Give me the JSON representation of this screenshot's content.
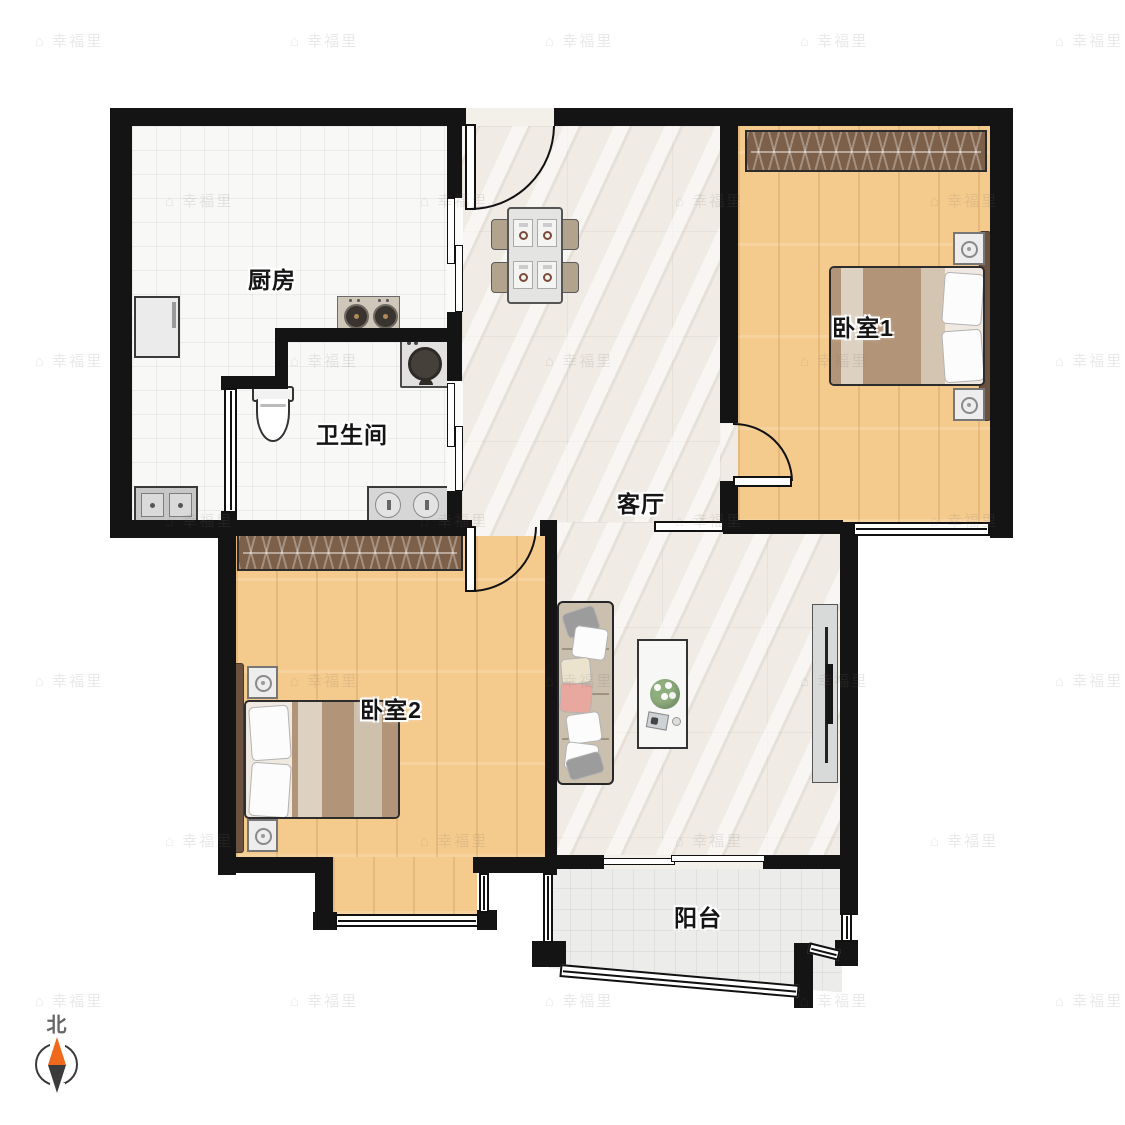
{
  "rooms": {
    "kitchen": {
      "label": "厨房",
      "furniture": [
        "refrigerator",
        "gas-stove",
        "kitchen-sink"
      ]
    },
    "bathroom": {
      "label": "卫生间",
      "furniture": [
        "toilet",
        "washing-machine",
        "double-basin-sink",
        "interior-window",
        "sliding-door"
      ]
    },
    "living_room": {
      "label": "客厅",
      "furniture": [
        "entry-door",
        "dining-table",
        "four-chairs",
        "sofa",
        "coffee-table",
        "tv-stand"
      ]
    },
    "bedroom_1": {
      "label": "卧室1",
      "furniture": [
        "wardrobe",
        "double-bed",
        "two-nightstands",
        "swing-door",
        "window"
      ]
    },
    "bedroom_2": {
      "label": "卧室2",
      "furniture": [
        "wardrobe",
        "double-bed",
        "two-nightstands",
        "swing-door",
        "bay-window"
      ]
    },
    "balcony": {
      "label": "阳台",
      "furniture": [
        "sliding-door",
        "wrap-around-windows"
      ]
    }
  },
  "compass": {
    "north_label": "北",
    "needle_north_color": "#f0681c",
    "needle_south_color": "#3b3b3b"
  },
  "watermark": {
    "icon": "⌂",
    "text": "幸福里"
  },
  "palette": {
    "wall": "#141414",
    "wood_floor": "#f4ca8d",
    "tile_floor": "#f8f8f7",
    "marble_floor": "#f0ebe5",
    "balcony_floor": "#ececeb",
    "wardrobe": "#7d6049",
    "bed_blanket": "#b29478",
    "sofa": "#cbc0ae",
    "accent_pillow": "#e8a8a0"
  }
}
